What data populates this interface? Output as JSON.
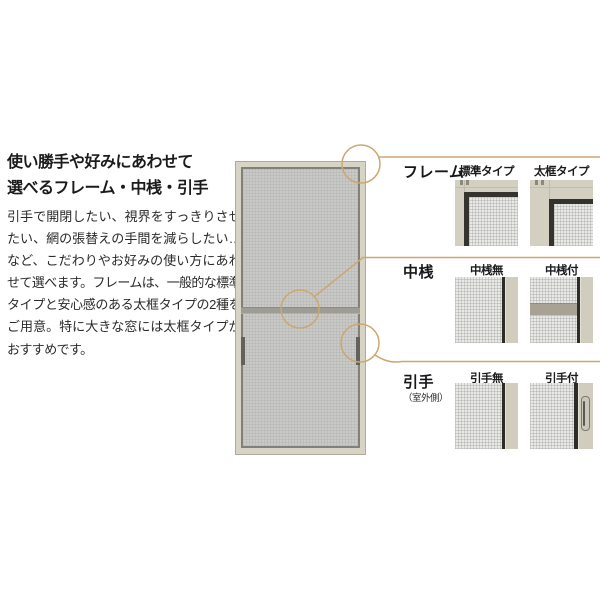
{
  "intro": {
    "heading": "使い勝手や好みにあわせて\n選べるフレーム・中桟・引手",
    "body": "引手で開閉したい、視界をすっきりさせたい、網の張替えの手間を減らしたい…など、こだわりやお好みの使い方にあわせて選べます。フレームは、一般的な標準タイプと安心感のある太框タイプの2種をご用意。特に大きな窓には太框タイプがおすすめです。"
  },
  "diagram": {
    "subject": "screen-door-illustration",
    "callout_targets": [
      "frame-top-corner",
      "middle-rail",
      "outdoor-handle"
    ]
  },
  "sections": [
    {
      "id": "frame",
      "label": "フレーム",
      "options": [
        {
          "label": "標準タイプ",
          "image": "corner-standard-frame"
        },
        {
          "label": "太框タイプ",
          "image": "corner-thick-frame"
        }
      ]
    },
    {
      "id": "nakazan",
      "label": "中桟",
      "options": [
        {
          "label": "中桟無",
          "image": "mesh-without-midrail"
        },
        {
          "label": "中桟付",
          "image": "mesh-with-midrail"
        }
      ]
    },
    {
      "id": "hikite",
      "label": "引手",
      "sublabel": "（室外側）",
      "options": [
        {
          "label": "引手無",
          "image": "mesh-without-handle"
        },
        {
          "label": "引手付",
          "image": "mesh-with-handle"
        }
      ]
    }
  ],
  "colors": {
    "accent_callout": "#cda76f",
    "frame_beige": "#d6d3c5",
    "mesh_gray": "#c9c9c7",
    "dark_frame": "#35332d",
    "text": "#1c1c1c",
    "background": "#ffffff"
  }
}
